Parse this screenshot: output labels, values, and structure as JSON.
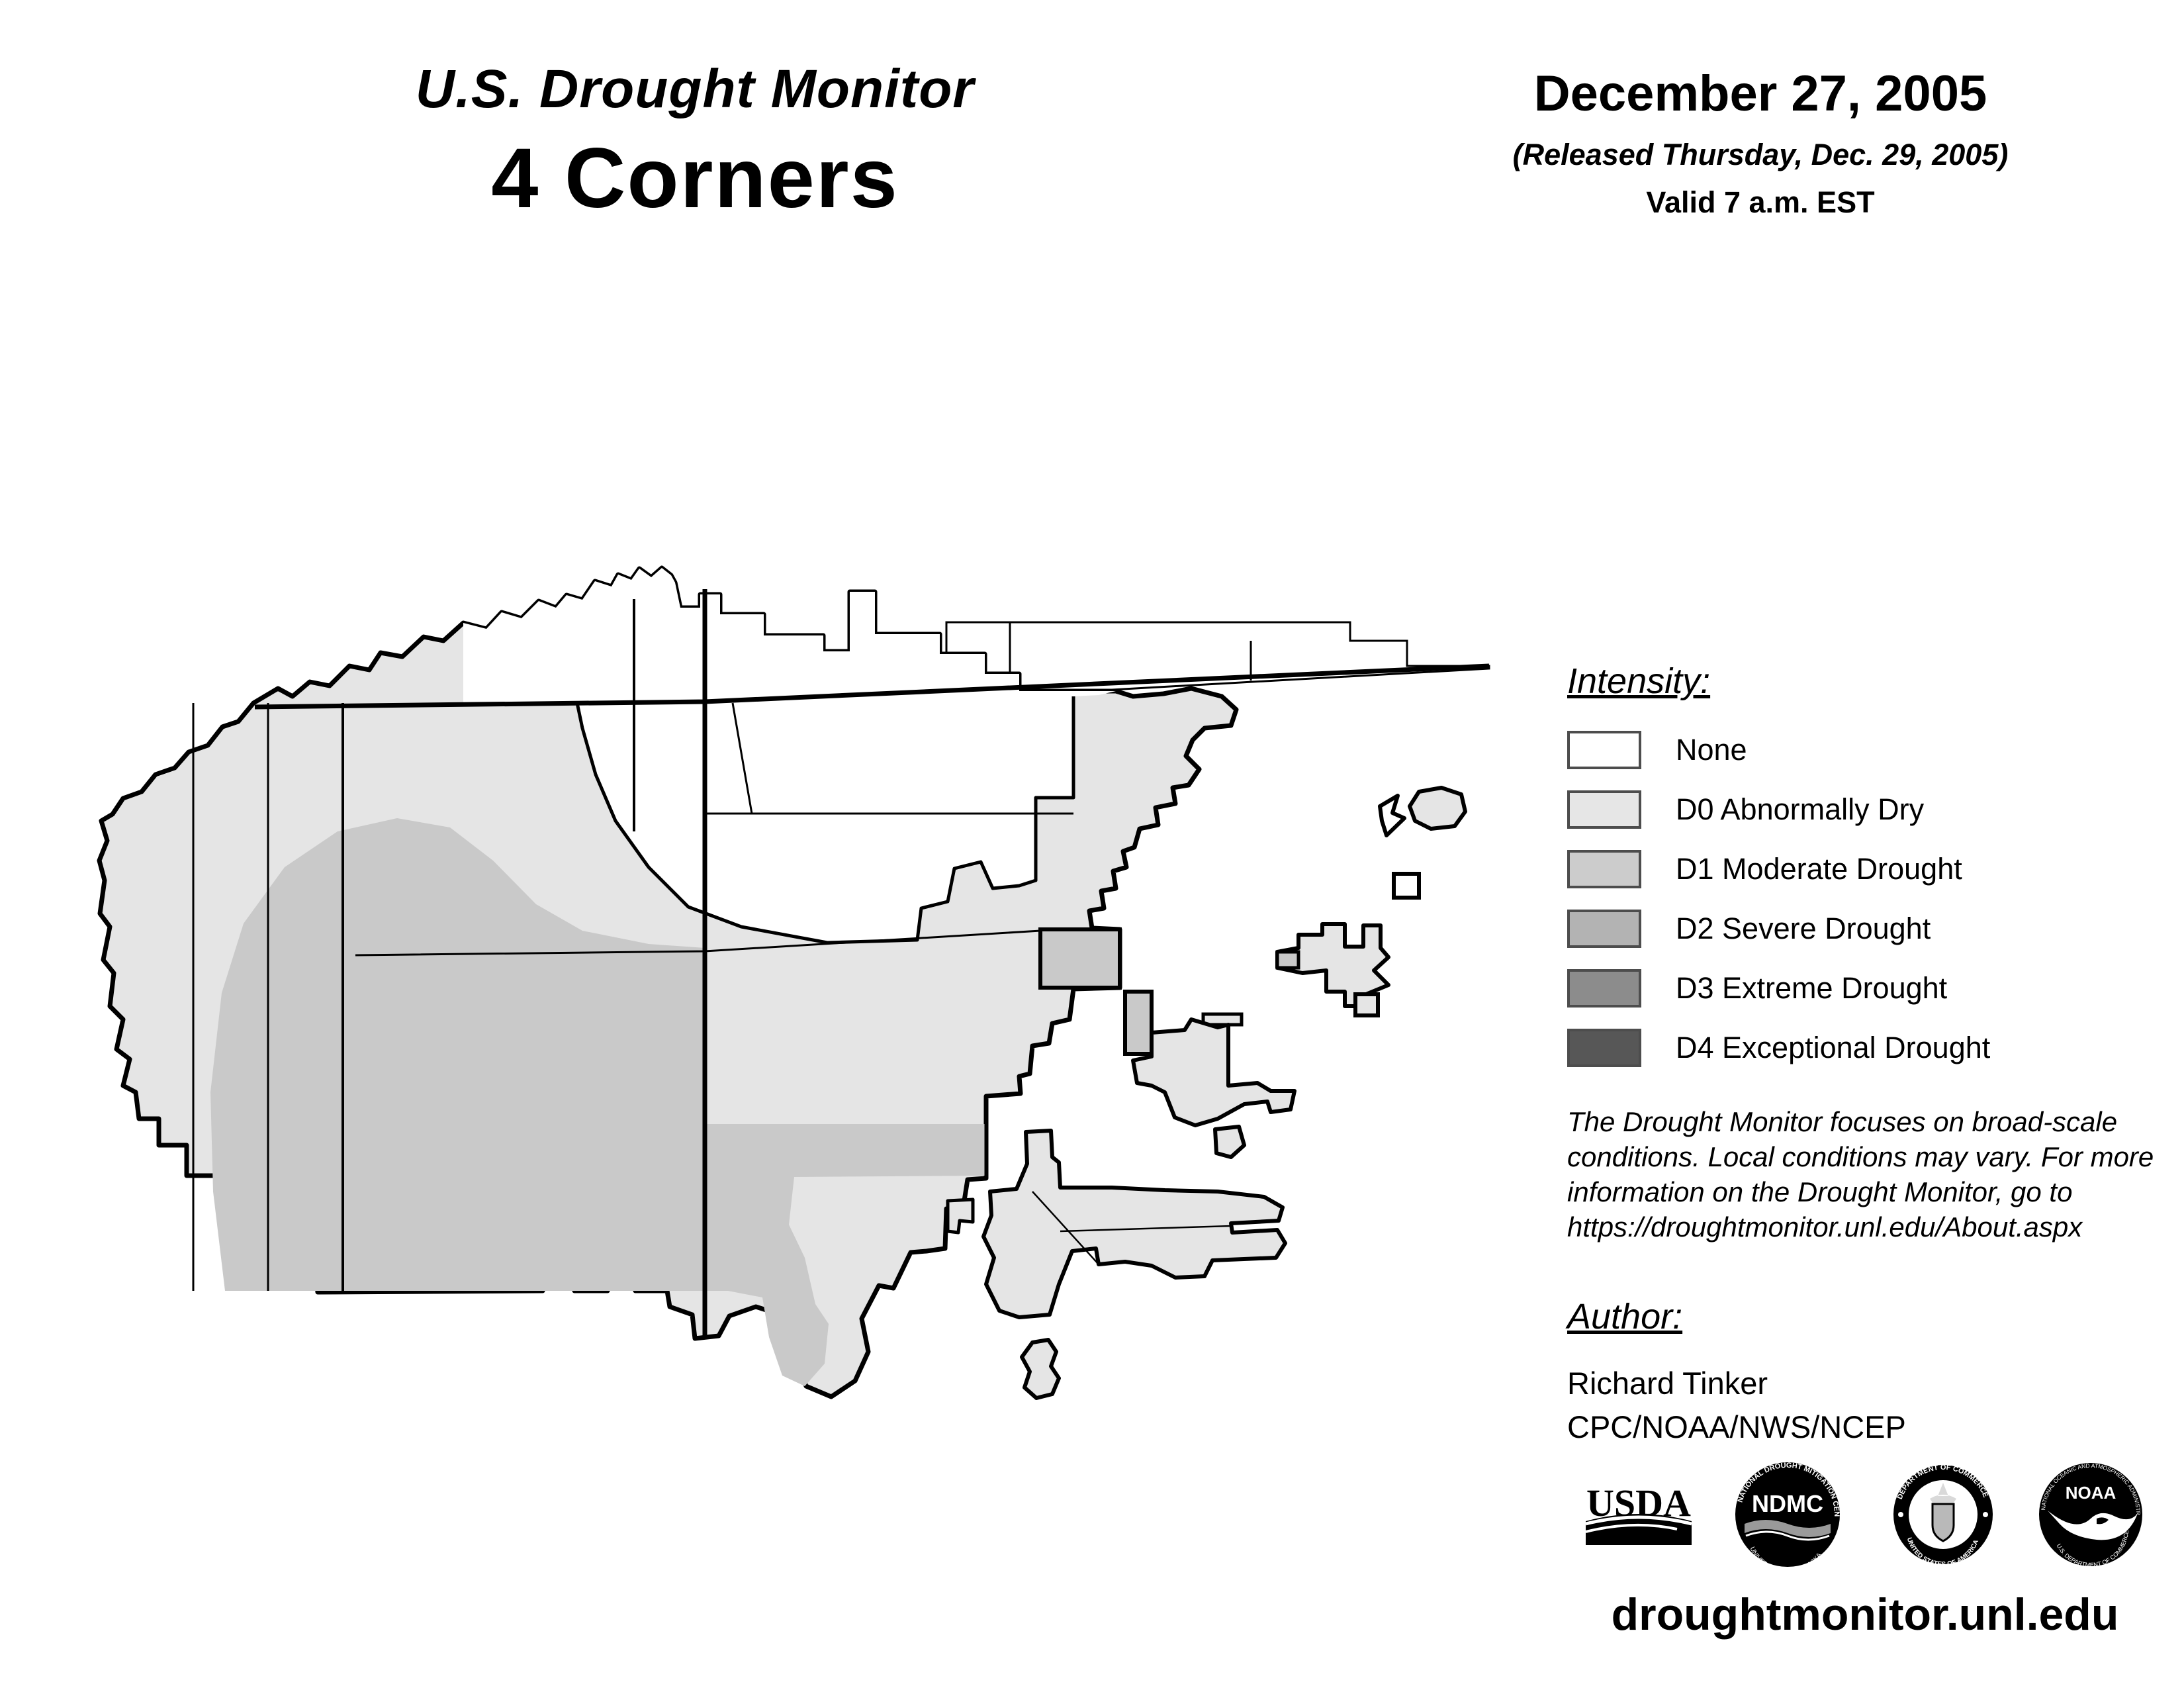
{
  "header": {
    "title_line1": "U.S. Drought Monitor",
    "title_line2": "4 Corners",
    "date": "December 27, 2005",
    "released": "(Released Thursday, Dec. 29, 2005)",
    "valid": "Valid 7 a.m. EST"
  },
  "legend": {
    "title": "Intensity:",
    "items": [
      {
        "label": "None",
        "color": "#ffffff"
      },
      {
        "label": "D0 Abnormally Dry",
        "color": "#e6e6e6"
      },
      {
        "label": "D1 Moderate Drought",
        "color": "#cccccc"
      },
      {
        "label": "D2 Severe Drought",
        "color": "#b3b3b3"
      },
      {
        "label": "D3 Extreme Drought",
        "color": "#8c8c8c"
      },
      {
        "label": "D4 Exceptional Drought",
        "color": "#575757"
      }
    ]
  },
  "disclaimer": {
    "lines": [
      "The Drought Monitor focuses on broad-scale",
      "conditions. Local conditions may vary. For more",
      "information on the Drought Monitor, go to",
      "https://droughtmonitor.unl.edu/About.aspx"
    ]
  },
  "author": {
    "title": "Author:",
    "name": "Richard Tinker",
    "org": "CPC/NOAA/NWS/NCEP"
  },
  "footer": {
    "url": "droughtmonitor.unl.edu"
  },
  "logos": {
    "usda": "USDA",
    "ndmc_center": "NDMC",
    "ndmc_top": "NATIONAL DROUGHT MITIGATION CENTER",
    "ndmc_bottom": "UNIVERSITY OF NEBRASKA",
    "doc_top": "DEPARTMENT OF COMMERCE",
    "doc_bottom": "UNITED STATES OF AMERICA",
    "noaa_center": "NOAA",
    "noaa_top": "NATIONAL OCEANIC AND ATMOSPHERIC ADMINISTRATION",
    "noaa_bottom": "U.S. DEPARTMENT OF COMMERCE"
  },
  "map": {
    "colors": {
      "none": "#ffffff",
      "d0": "#e5e5e5",
      "d1": "#c9c9c9",
      "outline": "#000000"
    }
  }
}
